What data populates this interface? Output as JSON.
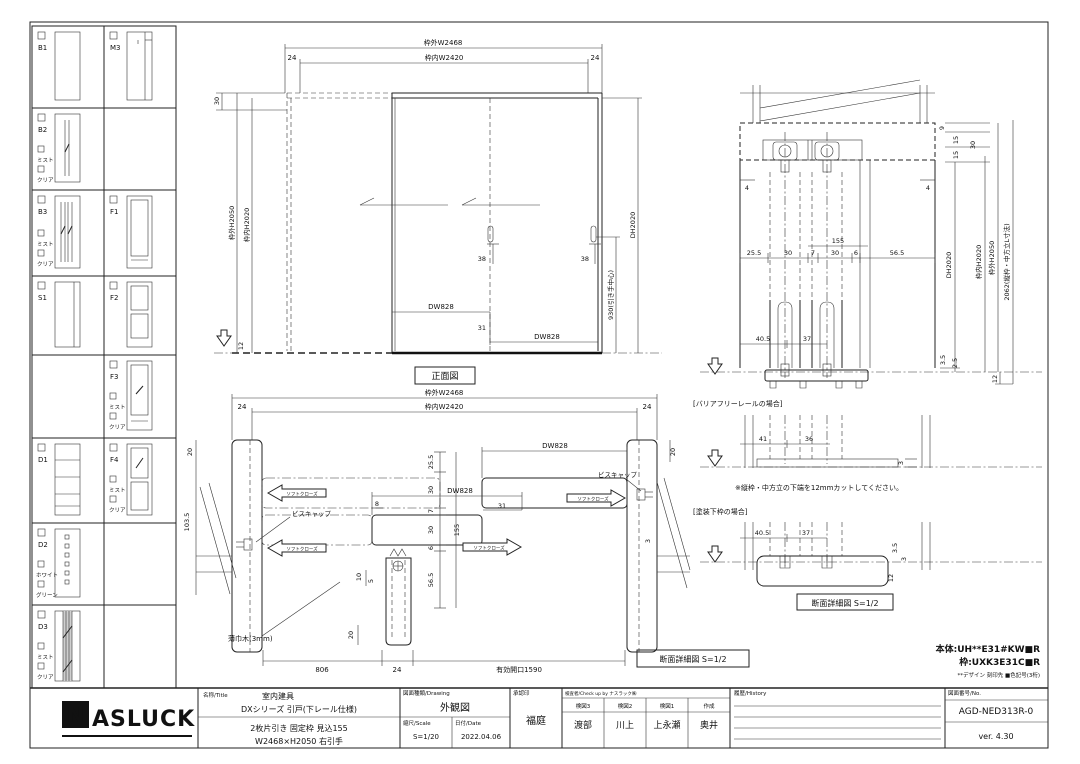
{
  "sidebar": {
    "cells": [
      {
        "code": "B1",
        "options": []
      },
      {
        "code": "M3",
        "options": []
      },
      {
        "code": "B2",
        "options": [
          "ミスト",
          "クリア"
        ]
      },
      {
        "code": "B3",
        "options": [
          "ミスト",
          "クリア"
        ]
      },
      {
        "code": "F1",
        "options": []
      },
      {
        "code": "S1",
        "options": []
      },
      {
        "code": "F2",
        "options": []
      },
      {
        "code": "F3",
        "options": [
          "ミスト",
          "クリア"
        ]
      },
      {
        "code": "D1",
        "options": []
      },
      {
        "code": "F4",
        "options": [
          "ミスト",
          "クリア"
        ]
      },
      {
        "code": "D2",
        "options": [
          "ホワイト",
          "グリーン"
        ]
      },
      {
        "code": "D3",
        "options": [
          "ミスト",
          "クリア"
        ]
      }
    ]
  },
  "front": {
    "label": "正面図",
    "outer_w": "枠外W2468",
    "inner_w": "枠内W2420",
    "m24l": "24",
    "m24r": "24",
    "m30": "30",
    "outer_h": "枠外H2050",
    "inner_h": "枠内H2020",
    "m12": "12",
    "dh": "DH2020",
    "handle_center": "930(引き手中心)",
    "m38a": "38",
    "m38b": "38",
    "dw1": "DW828",
    "dw2": "DW828",
    "m31": "31"
  },
  "plan": {
    "outer_w": "枠外W2468",
    "inner_w": "枠内W2420",
    "m24l": "24",
    "m24r": "24",
    "m20l": "20",
    "m20r": "20",
    "m103": "103.5",
    "dw1": "DW828",
    "dw2": "DW828",
    "m25": "25.5",
    "m30a": "30",
    "m7": "7",
    "m30b": "30",
    "m6": "6",
    "m155": "155",
    "m56": "56.5",
    "m8": "8",
    "m31": "31",
    "m3": "3",
    "m10": "10",
    "m5": "5",
    "m20b": "20",
    "soft_close": "ソフトクローズ",
    "screw_cap": "ビスキャップ",
    "baseboard": "薄巾木(3mm)",
    "b806": "806",
    "b24": "24",
    "opening": "有効開口1590",
    "section_label": "断面詳細図 S=1/2"
  },
  "rsec": {
    "m4l": "4",
    "m4r": "4",
    "m155": "155",
    "m25": "25.5",
    "m30a": "30",
    "m7": "7",
    "m30b": "30",
    "m6": "6",
    "m56": "56.5",
    "m40": "40.5",
    "m37": "37",
    "m9": "9",
    "m15a": "15",
    "m15b": "15",
    "m30t": "30",
    "dh": "DH2020",
    "inner_h": "枠内H2020",
    "outer_h": "枠外H2050",
    "stile": "2062(縦枠・中方立L寸法)",
    "m35": "3.5",
    "m25b": "2.5",
    "m12": "12"
  },
  "barrier": {
    "title": "[バリアフリーレールの場合]",
    "m41": "41",
    "m36": "36",
    "m3": "3",
    "note": "※縦枠・中方立の下端を12mmカットしてください。"
  },
  "paint": {
    "title": "[塗装下枠の場合]",
    "m40": "40.5",
    "m37": "37",
    "m35": "3.5",
    "m3": "3",
    "m12": "12",
    "label": "断面詳細図 S=1/2"
  },
  "codes": {
    "body": "本体:UH**E31#KW■R",
    "frame": "枠:UXK3E31C■R",
    "note": "**デザイン 刻印先 ■色記号(3桁)"
  },
  "title_block": {
    "logo_n": "N",
    "logo_rest": "ASLUCK",
    "name_label": "名称/Title",
    "name_value": "室内建具",
    "name_line2": "DXシリーズ 引戸(下レール仕様)",
    "spec_line1": "2枚片引き 固定枠 見込155",
    "spec_line2": "W2468×H2050 右引手",
    "drawing_label": "図面種類/Drawing",
    "drawing_value": "外観図",
    "scale_label": "縮尺/Scale",
    "scale_value": "S=1/20",
    "date_label": "日付/Date",
    "date_value": "2022.04.06",
    "stamp_label": "承認印",
    "stamp_value": "福庭",
    "check_label": "検査者/Check up by ナスラック㈱",
    "check_cols": [
      "検図3",
      "検図2",
      "検図1",
      "作成"
    ],
    "check_values": [
      "渡部",
      "川上",
      "上永瀬",
      "奥井"
    ],
    "history_label": "履歴/History",
    "no_label": "図面番号/No.",
    "no_value": "AGD-NED313R-0",
    "version": "ver. 4.30"
  }
}
